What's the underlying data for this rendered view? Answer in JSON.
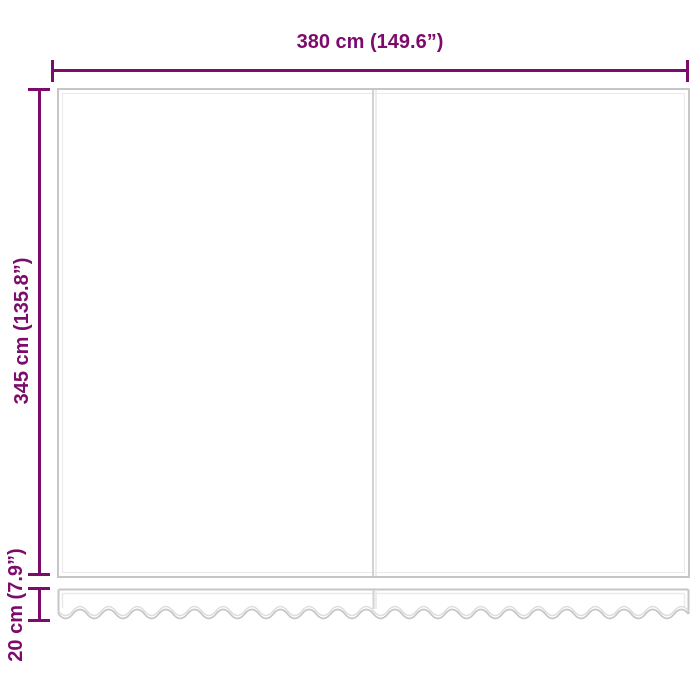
{
  "diagram": {
    "type": "product-dimension-diagram",
    "subject": "awning-replacement-fabric-with-valance",
    "background_color": "#ffffff",
    "accent_color": "#7c0b6b",
    "outline_color": "#c6c6c6",
    "outline_highlight_color": "#e9e9e9",
    "labels": {
      "width": "380 cm (149.6”)",
      "height": "345 cm (135.8”)",
      "valance_height": "20 cm (7.9”)"
    }
  }
}
